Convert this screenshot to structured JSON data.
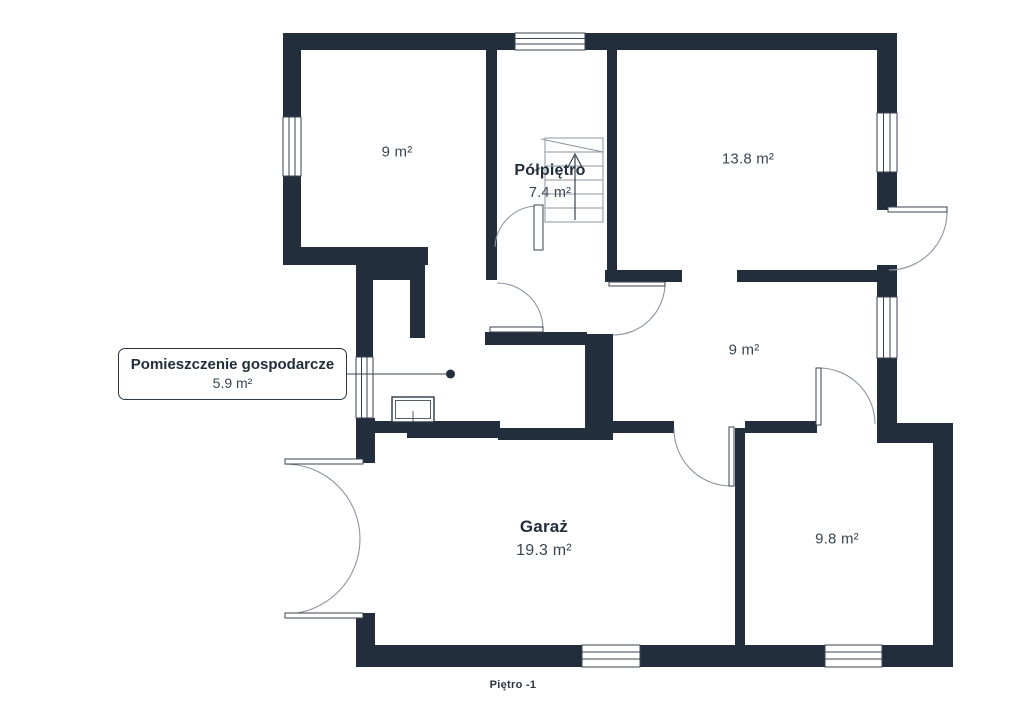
{
  "floor_plan": {
    "footer_label": "Piętro -1",
    "callout": {
      "title": "Pomieszczenie gospodarcze",
      "area": "5.9 m²"
    },
    "rooms": [
      {
        "key": "top-left",
        "area": "9 m²"
      },
      {
        "key": "polpietro",
        "name": "Półpiętro",
        "area": "7.4 m²"
      },
      {
        "key": "top-right",
        "area": "13.8 m²"
      },
      {
        "key": "middle-right",
        "area": "9 m²"
      },
      {
        "key": "garage",
        "name": "Garaż",
        "area": "19.3 m²"
      },
      {
        "key": "bottom-right",
        "area": "9.8 m²"
      }
    ],
    "colors": {
      "wall": "#232e3c",
      "thin_line": "#8d949d",
      "frame_line": "#39434f",
      "background": "#ffffff",
      "text_primary": "#232e3c",
      "text_secondary": "#3a4553"
    }
  }
}
